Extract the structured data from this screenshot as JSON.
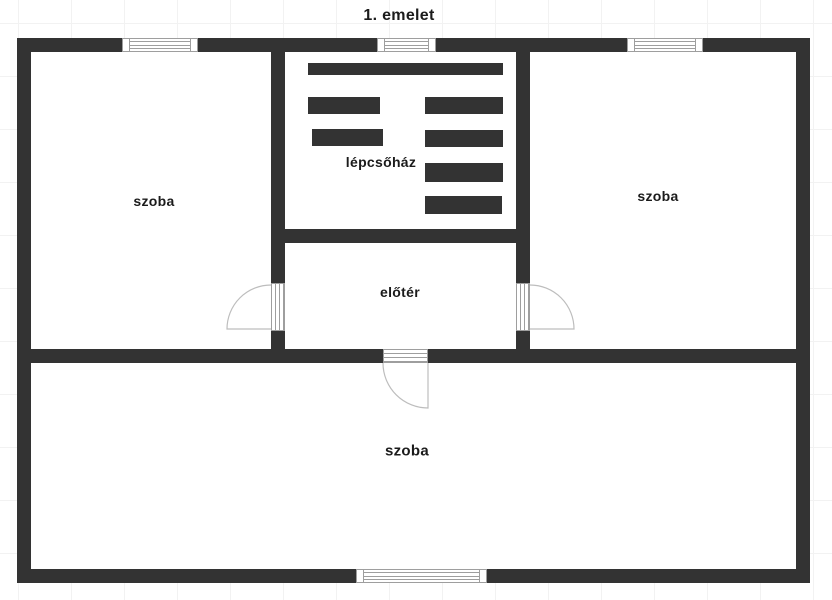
{
  "title": "1. emelet",
  "colors": {
    "wall": "#333333",
    "label_text": "#1b1b1b",
    "background": "#ffffff",
    "grid_line": "#f2f2f2",
    "window_border": "#9e9e9e",
    "door_arc": "#bdbdbd"
  },
  "rooms": {
    "room_left": {
      "label": "szoba"
    },
    "staircase": {
      "label": "lépcsőház"
    },
    "room_right": {
      "label": "szoba"
    },
    "foyer": {
      "label": "előtér"
    },
    "room_bottom": {
      "label": "szoba"
    }
  }
}
